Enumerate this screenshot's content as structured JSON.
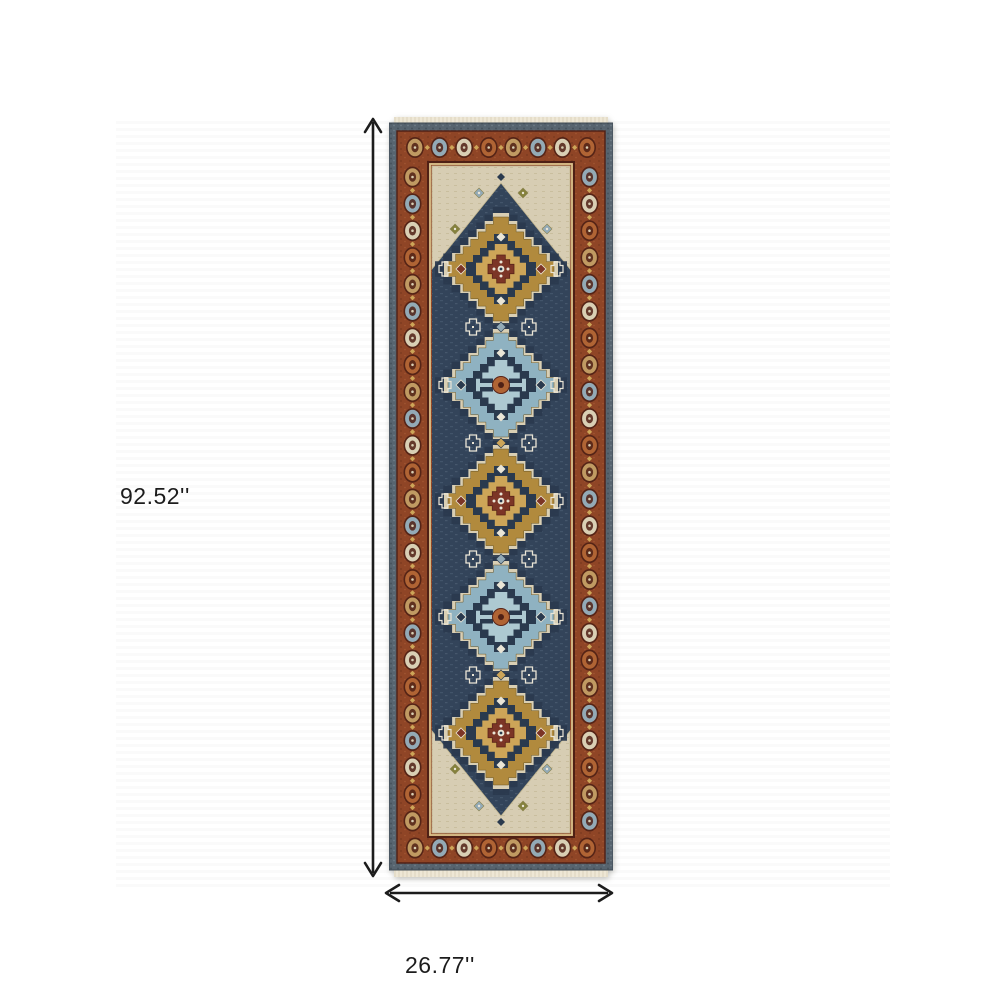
{
  "page": {
    "background": "#ffffff"
  },
  "photo": {
    "stripe_a": "#ffffff",
    "stripe_b": "#fafafa"
  },
  "annotations": {
    "height_label": "92.52''",
    "width_label": "26.77''",
    "color": "#1c1c1c"
  },
  "rug": {
    "description": "oriental-runner-rug-photo",
    "medallions": [
      {
        "shade": "gold"
      },
      {
        "shade": "blue"
      },
      {
        "shade": "gold"
      },
      {
        "shade": "blue"
      },
      {
        "shade": "gold"
      }
    ],
    "border_motif_cycle": [
      "tan",
      "bluegray",
      "cream",
      "rust_rosette"
    ],
    "palette": {
      "fringe": "#eee7d5",
      "outer_band": "#57646f",
      "outer_band_dark": "#46525c",
      "rust": "#8f4526",
      "rust_dark": "#4f2015",
      "cream_line": "#d9c18b",
      "navy": "#33445a",
      "navy_dark": "#2a3a4e",
      "navy_light": "#4e6076",
      "ivory": "#d7cdb3",
      "gold": "#b18a3d",
      "gold_light": "#cda558",
      "blue": "#8fb2c1",
      "blue_light": "#adc9d1",
      "red_center": "#7c3526",
      "rust_rosette": "#b06434",
      "white": "#eae5d6",
      "olive": "#85813c",
      "tan": "#c09a62",
      "bluegray": "#93aab6",
      "cream": "#d9cfb4"
    }
  }
}
